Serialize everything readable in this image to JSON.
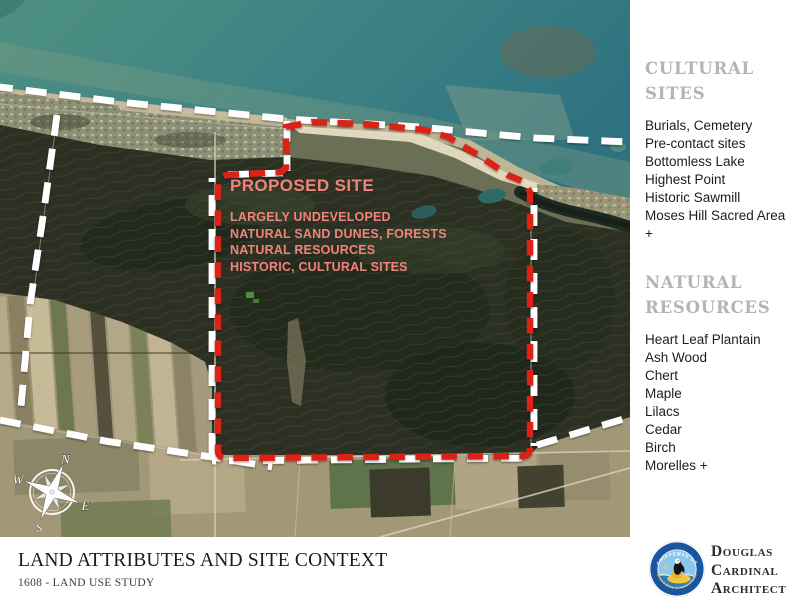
{
  "map": {
    "overlay": {
      "title": "PROPOSED SITE",
      "lines": [
        "LARGELY UNDEVELOPED",
        "NATURAL SAND DUNES, FORESTS",
        "NATURAL RESOURCES",
        "HISTORIC, CULTURAL SITES"
      ]
    },
    "compass": {
      "n": "N",
      "e": "E",
      "s": "S",
      "w": "W"
    },
    "colors": {
      "site_boundary_red": "#dc2418",
      "reserve_boundary_white": "#ffffff",
      "overlay_text_salmon": "#f2837b"
    }
  },
  "sidebar": {
    "heading_color": "#b4b4b4",
    "sections": [
      {
        "title_line1": "CULTURAL",
        "title_line2": "SITES",
        "items": [
          "Burials, Cemetery",
          "Pre-contact sites",
          "Bottomless Lake",
          "Highest Point",
          "Historic Sawmill",
          "Moses Hill Sacred Area +"
        ]
      },
      {
        "title_line1": "NATURAL",
        "title_line2": "RESOURCES",
        "items": [
          "Heart Leaf Plantain",
          "Ash Wood",
          "Chert",
          "Maple",
          "Lilacs",
          "Cedar",
          "Birch",
          "Morelles +"
        ]
      }
    ]
  },
  "footer": {
    "title": "LAND ATTRIBUTES AND SITE CONTEXT",
    "subtitle": "1608 - LAND USE STUDY"
  },
  "brand": {
    "name_line1": "Douglas",
    "name_line2": "Cardinal",
    "name_line3": "Architect",
    "seal": {
      "top_text": "CHIPPEWAS OF",
      "bottom_text": "Kettle & Stony Point First Nation",
      "blue": "#1a55a0",
      "yellow": "#f2c83d"
    }
  }
}
